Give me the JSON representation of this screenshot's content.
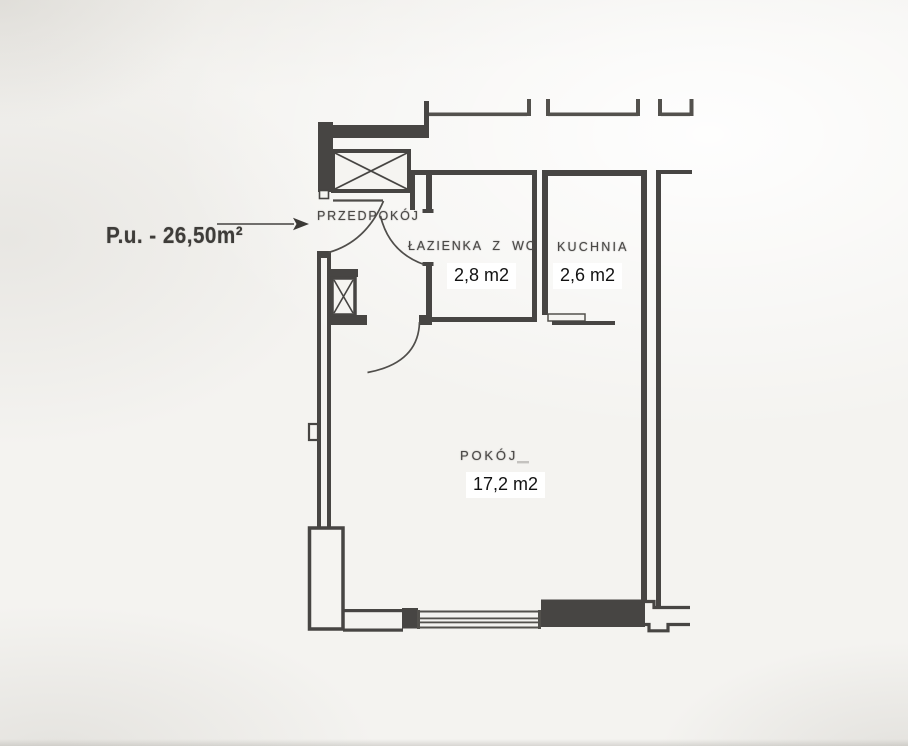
{
  "annotation": {
    "total_area_label": "P.u. - 26,50m²"
  },
  "rooms": [
    {
      "id": "przedpokoj",
      "name": "PRZEDPOKÓJ"
    },
    {
      "id": "lazienka",
      "name": "ŁAZIENKA Z WC",
      "area": "2,8 m2"
    },
    {
      "id": "kuchnia",
      "name": "KUCHNIA",
      "area": "2,6 m2"
    },
    {
      "id": "pokoj",
      "name": "POKÓJ",
      "area": "17,2 m2"
    }
  ]
}
